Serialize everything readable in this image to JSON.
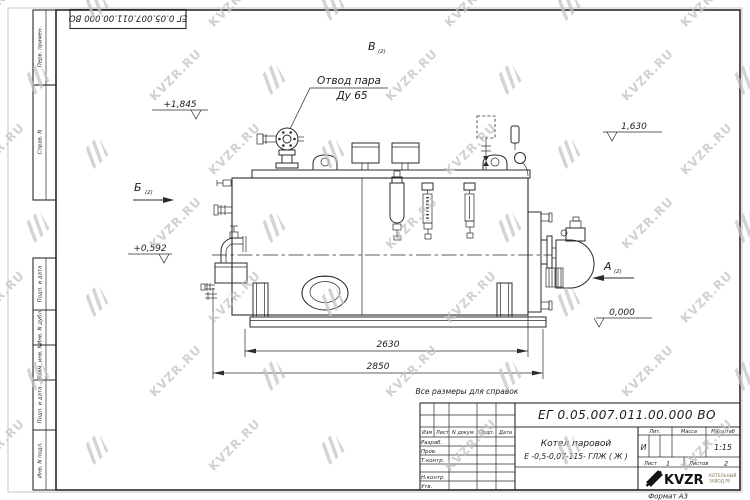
{
  "colors": {
    "line": "#2b2b2b",
    "watermark": "#c2c2c2",
    "company_text": "#8a7055"
  },
  "watermark": {
    "text": "KVZR.RU"
  },
  "corner_stamp": {
    "doc_number": "ЕГ 0.05.007.011.00.000  ВО"
  },
  "margin_columns": {
    "perv_primen": "Перв. примен.",
    "sprav_n": "Справ. N",
    "podp_data_1": "Подп. и дата",
    "inv_n_dubl": "Инв. N дубл.",
    "vzam_inv_n": "Взам. инв. N",
    "podp_data_2": "Подп. и дата",
    "inv_n_podl": "Инв. N подл."
  },
  "drawing": {
    "steam_outlet_label_1": "Отвод пара",
    "steam_outlet_label_2": "Ду 65",
    "view_v": "В",
    "view_b": "Б",
    "view_a": "А",
    "sheet_ref": "(2)",
    "elevations": [
      "+1,845",
      "1,630",
      "+0,592",
      "0,000"
    ],
    "dim_length_1": "2630",
    "dim_length_2": "2850",
    "note": "Все размеры для справок"
  },
  "title_block": {
    "doc_number": "ЕГ 0.05.007.011.00.000  ВО",
    "product_name": "Котел паровой",
    "product_type": "Е -0,5-0,07-115- ГЛЖ ( Ж )",
    "col_izm": "Изм",
    "col_list": "Лист",
    "col_n_dokum": "N докум.",
    "col_podp": "Подп.",
    "col_data": "Дата",
    "row_razrab": "Разраб.",
    "row_prov": "Пров.",
    "row_tkontr": "Т.контр.",
    "row_nkontr": "Н.контр.",
    "row_utv": "Утв.",
    "lit_label": "Лит.",
    "lit_value": "И",
    "massa_label": "Масса",
    "masshtab_label": "Масштаб",
    "masshtab_value": "1:15",
    "sheet_label": "Лист",
    "sheet_value": "1",
    "sheets_label": "Листов",
    "sheets_value": "2",
    "company_name": "KVZR",
    "company_line1": "КОТЕЛЬНЫЙ",
    "company_line2": "ЗАВОД.РУ",
    "format_label": "Формат А3"
  }
}
